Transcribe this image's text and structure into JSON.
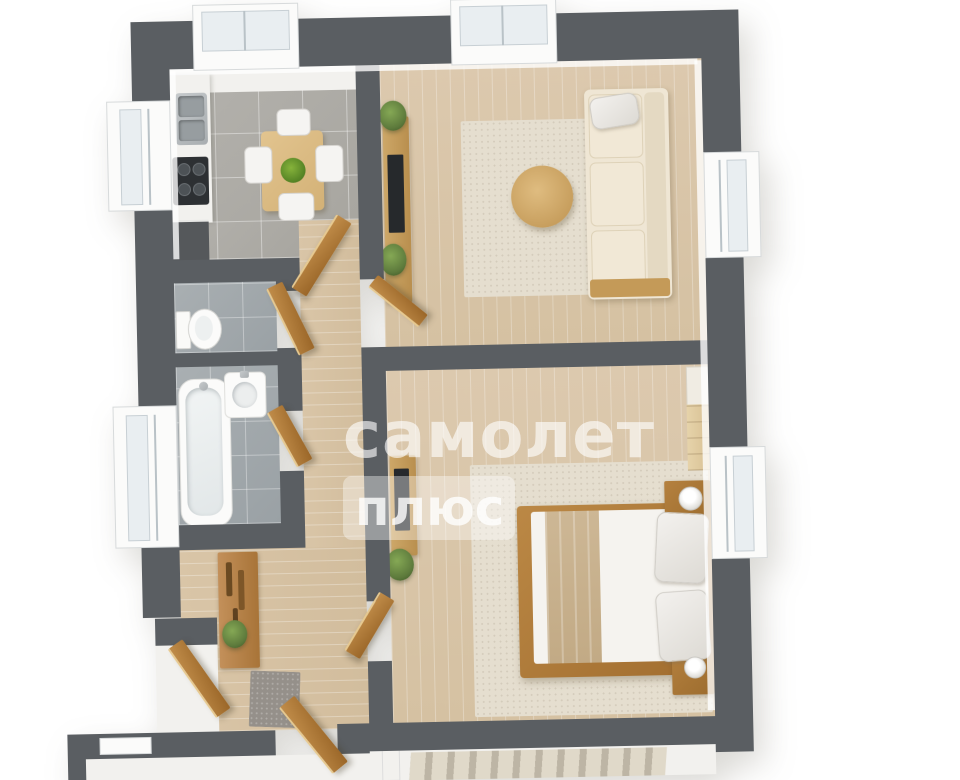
{
  "page": {
    "type": "3d-floorplan-render",
    "background": "#ffffff"
  },
  "watermark": {
    "brand": "самолет",
    "suffix": "плюс"
  },
  "palette": {
    "wall": "#5a5e62",
    "floor_wood": "#dcc9ae",
    "floor_hall": "#d9c5a7",
    "tile_kitchen": "#b3b1ac",
    "tile_bath": "#a9afb2",
    "rug": "#e5decf",
    "sofa": "#efe6d4",
    "door_wood_light": "#c08c49",
    "door_wood_dark": "#9a6628",
    "furniture_wood": "#b5813f",
    "table_wood": "#e2c48f",
    "plant_green": "#5d7a3c",
    "glass": "#e9eef1",
    "watermark_text": "rgba(255,255,255,0.62)",
    "watermark_badge": "rgba(255,255,255,0.38)"
  },
  "rooms": [
    {
      "name": "kitchen",
      "items": [
        "counter",
        "double-sink",
        "cooktop",
        "base-unit",
        "dining-table",
        "four-chairs",
        "fruit-bowl",
        "window"
      ]
    },
    {
      "name": "living-room",
      "items": [
        "sofa",
        "coffee-table",
        "rug",
        "tv-stand",
        "tv",
        "plants",
        "windows"
      ]
    },
    {
      "name": "wc",
      "items": [
        "toilet"
      ]
    },
    {
      "name": "bathroom",
      "items": [
        "bathtub",
        "washbasin",
        "window"
      ]
    },
    {
      "name": "hallway",
      "items": [
        "console-coat-rack",
        "plant",
        "doormat",
        "open-doors"
      ]
    },
    {
      "name": "bedroom",
      "items": [
        "double-bed",
        "pillows",
        "blanket",
        "nightstands",
        "lamps",
        "wardrobe",
        "tv-stand",
        "rug",
        "window"
      ]
    },
    {
      "name": "stair-landing",
      "items": [
        "staircase",
        "radiator"
      ]
    }
  ]
}
